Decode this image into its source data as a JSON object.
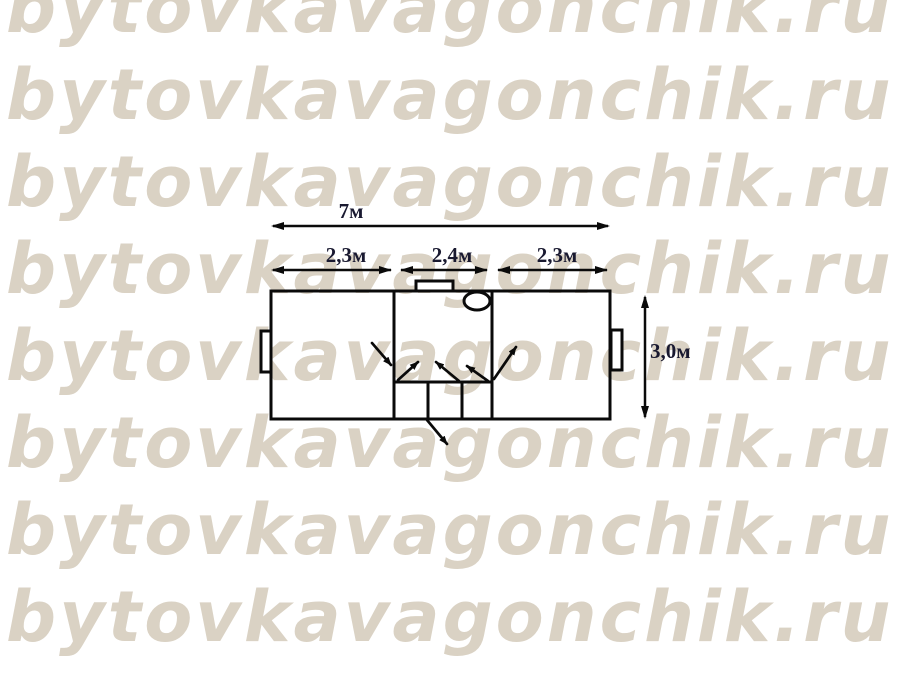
{
  "watermark": {
    "text": "bytovkavagonchik.ru",
    "color": "#dad2c4",
    "rows": 8
  },
  "floor_plan": {
    "type": "cabin-layout-top-view",
    "line_color": "#0a0a0a",
    "label_color": "#191930",
    "dimensions": {
      "total_width": "7м",
      "left_section": "2,3м",
      "middle_section": "2,4м",
      "right_section": "2,3м",
      "height": "3,0м"
    }
  }
}
